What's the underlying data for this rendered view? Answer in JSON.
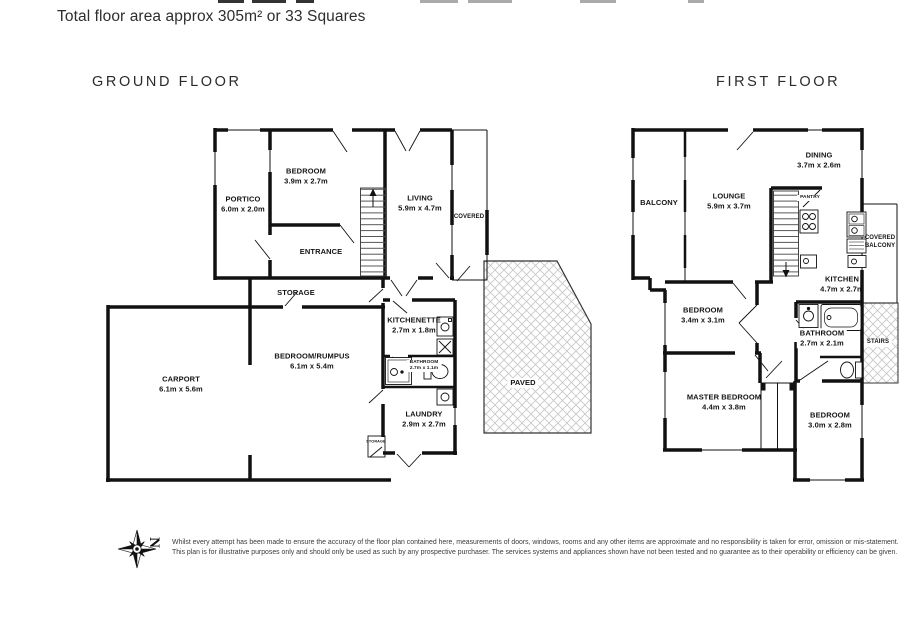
{
  "page": {
    "header": "Total floor area approx 305m² or 33 Squares",
    "disclaimer_line1": "Whilst every attempt has been made to ensure the accuracy of the floor plan contained here, measurements of doors, windows, rooms and any other items are approximate and no responsibility is taken for error, omission or mis-statement.",
    "disclaimer_line2": "This plan is for illustrative purposes only and should only be used as such by any prospective purchaser. The services systems and appliances shown have not been tested and no guarantee as to their operability or efficiency can be given.",
    "compass_label": "N"
  },
  "ground": {
    "title": "GROUND FLOOR",
    "rooms": {
      "portico": {
        "name": "PORTICO",
        "dims": "6.0m x 2.0m"
      },
      "bedroom": {
        "name": "BEDROOM",
        "dims": "3.9m x 2.7m"
      },
      "living": {
        "name": "LIVING",
        "dims": "5.9m x 4.7m"
      },
      "entrance": {
        "name": "ENTRANCE"
      },
      "covered": {
        "name": "COVERED"
      },
      "storage": {
        "name": "STORAGE"
      },
      "carport": {
        "name": "CARPORT",
        "dims": "6.1m x 5.6m"
      },
      "bedroom_rumpus": {
        "name": "BEDROOM/RUMPUS",
        "dims": "6.1m x 5.4m"
      },
      "kitchenette": {
        "name": "KITCHENETTE",
        "dims": "2.7m x 1.8m"
      },
      "bathroom": {
        "name": "BATHROOM",
        "dims": "2.7m x 1.1m"
      },
      "laundry": {
        "name": "LAUNDRY",
        "dims": "2.9m x 2.7m"
      },
      "storage_small": {
        "name": "STORAGE"
      },
      "paved": {
        "name": "PAVED"
      }
    }
  },
  "first": {
    "title": "FIRST FLOOR",
    "rooms": {
      "balcony": {
        "name": "BALCONY"
      },
      "lounge": {
        "name": "LOUNGE",
        "dims": "5.9m x 3.7m"
      },
      "dining": {
        "name": "DINING",
        "dims": "3.7m x 2.6m"
      },
      "pantry": {
        "name": "PANTRY"
      },
      "kitchen": {
        "name": "KITCHEN",
        "dims": "4.7m x 2.7m"
      },
      "covered_balcony": {
        "line1": "COVERED",
        "line2": "BALCONY"
      },
      "bedroom1": {
        "name": "BEDROOM",
        "dims": "3.4m x 3.1m"
      },
      "bathroom": {
        "name": "BATHROOM",
        "dims": "2.7m x 2.1m"
      },
      "stairs": {
        "name": "STAIRS"
      },
      "master_bedroom": {
        "name": "MASTER BEDROOM",
        "dims": "4.4m x 3.8m"
      },
      "bedroom2": {
        "name": "BEDROOM",
        "dims": "3.0m x 2.8m"
      }
    }
  }
}
